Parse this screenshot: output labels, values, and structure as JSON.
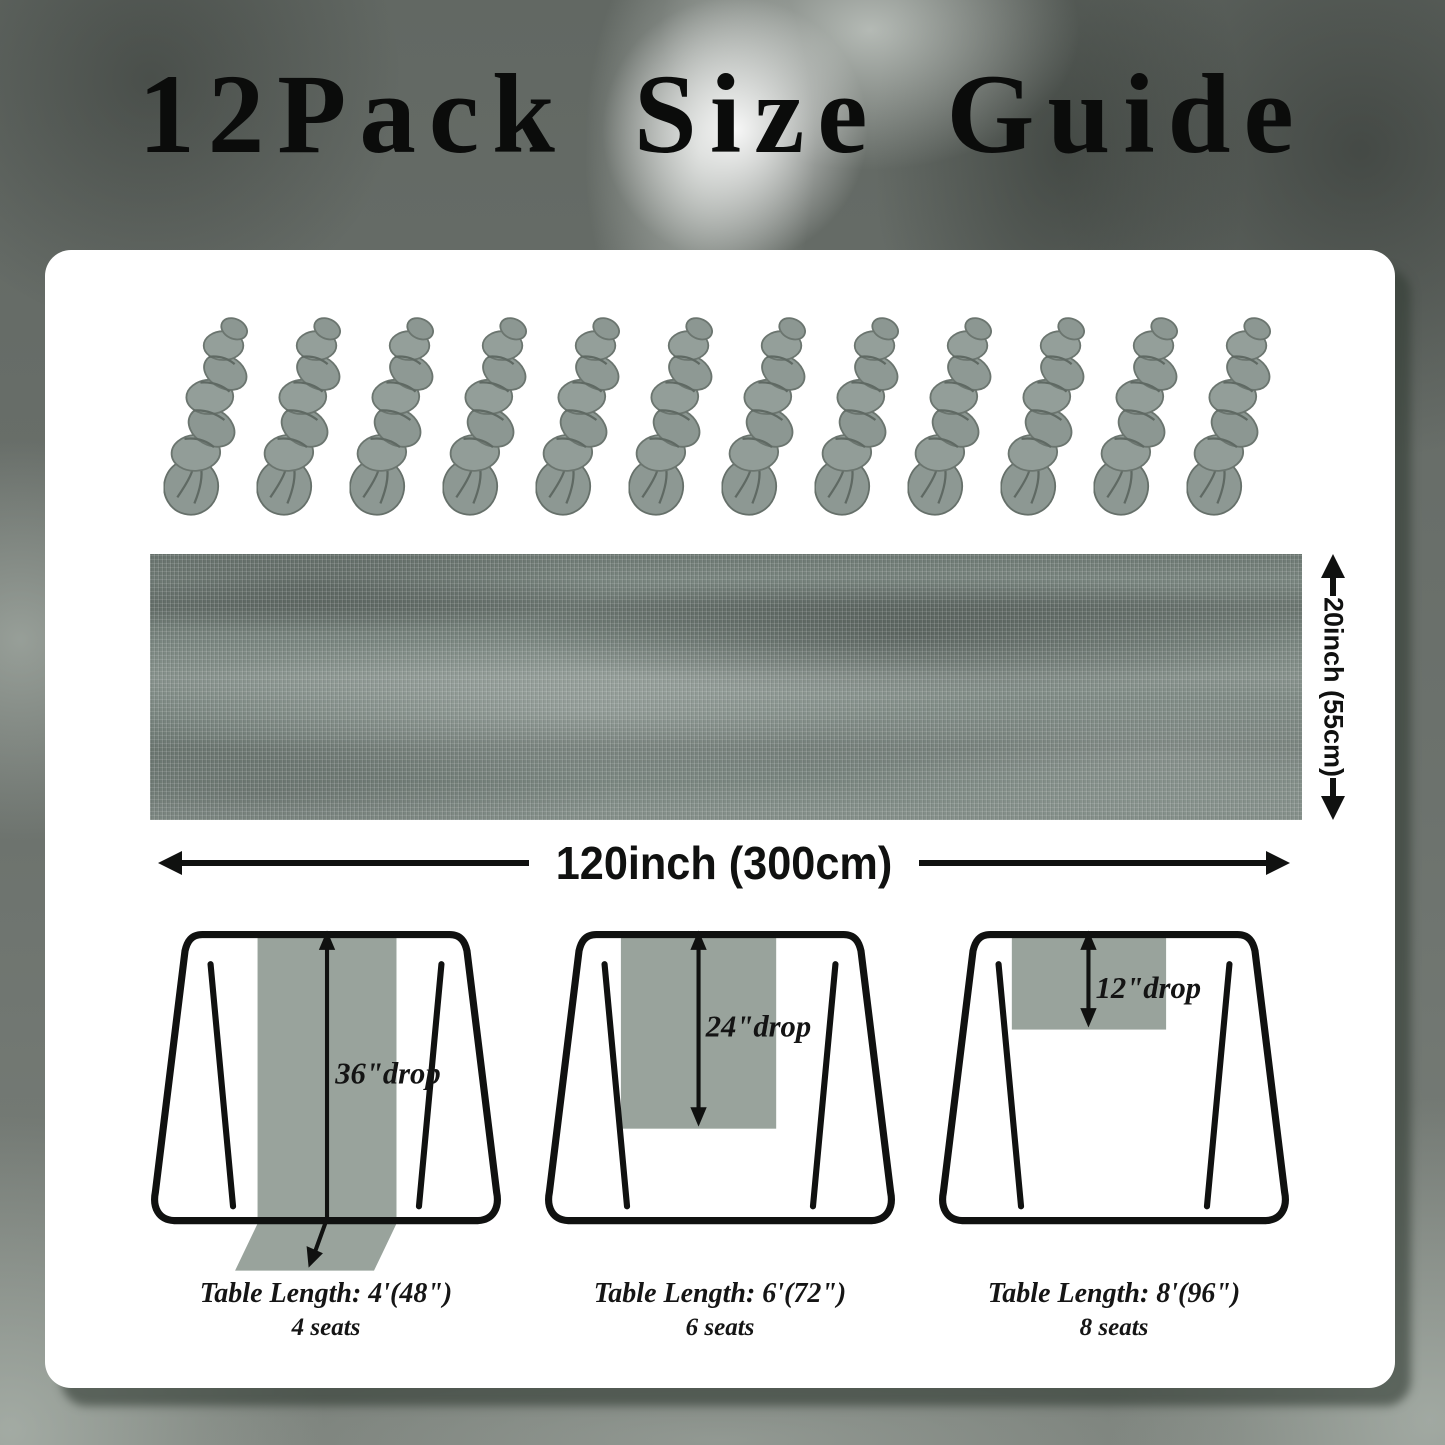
{
  "title": "12Pack Size Guide",
  "pack": {
    "count": 12,
    "item": "fabric-skein"
  },
  "dimensions": {
    "width_label": "120inch (300cm)",
    "height_label": "20inch (55cm)"
  },
  "tables": [
    {
      "drop": "36\"drop",
      "length": "Table Length: 4'(48\")",
      "seats": "4 seats"
    },
    {
      "drop": "24\"drop",
      "length": "Table Length: 6'(72\")",
      "seats": "6 seats"
    },
    {
      "drop": "12\"drop",
      "length": "Table Length: 8'(96\")",
      "seats": "8 seats"
    }
  ],
  "colors": {
    "card": "#ffffff",
    "runner": "#99a39c",
    "fabric": "#79857f",
    "outline": "#101110",
    "background_base": "#6e746f"
  }
}
